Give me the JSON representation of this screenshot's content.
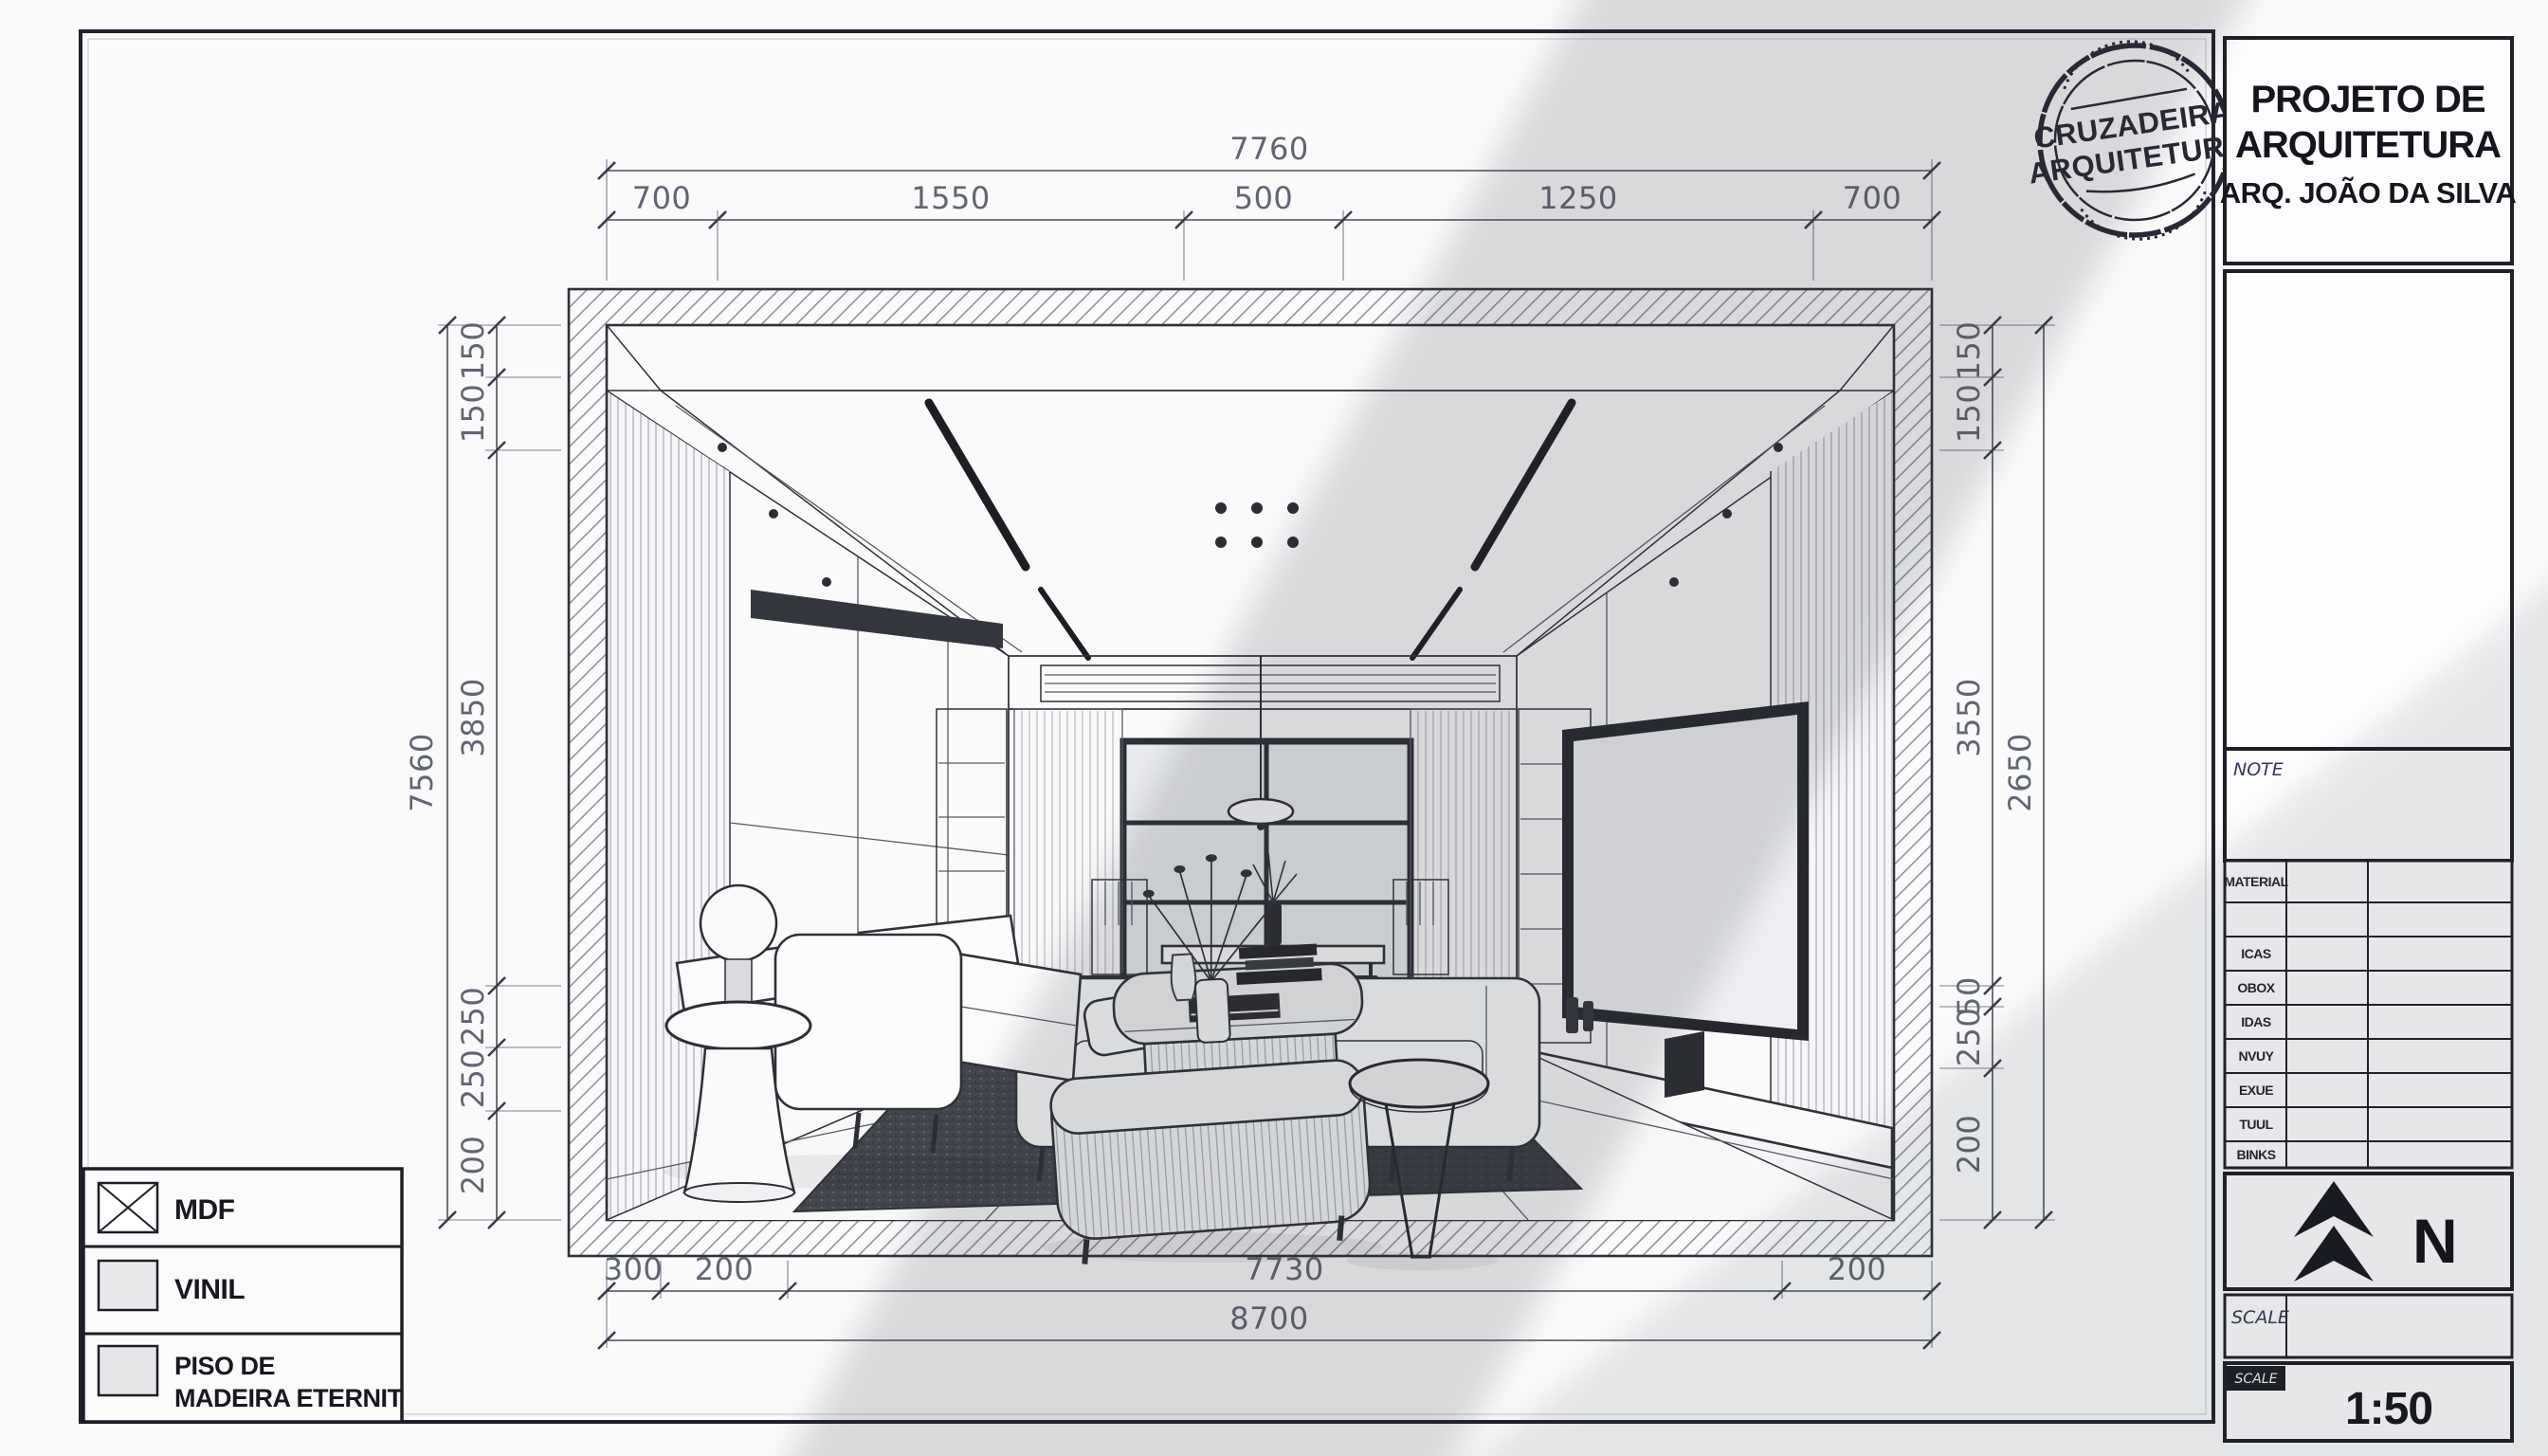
{
  "title_block": {
    "project_title_line1": "PROJETO DE",
    "project_title_line2": "ARQUITETURA",
    "architect": "ARQ. JOÃO DA SILVA",
    "note_label": "NOTE",
    "info_table": {
      "rows": [
        "MATERIAL",
        "",
        "ICAS",
        "OBOX",
        "IDAS",
        "NVUY",
        "EXUE",
        "TUUL",
        "BINKS"
      ]
    },
    "north_label": "N",
    "scale_row_label": "SCALE",
    "scale_label": "SCALE",
    "scale_value": "1:50"
  },
  "stamp": {
    "line1": "CRUZADEIRA",
    "line2": "ARQUITETURA"
  },
  "legend": {
    "items": [
      {
        "label": "MDF",
        "swatch": "x-hatch"
      },
      {
        "label": "VINIL",
        "swatch": "light-solid"
      },
      {
        "label": "PISO DE",
        "label2": "MADEIRA ETERNIT",
        "swatch": "gray-solid"
      }
    ]
  },
  "dims": {
    "top": {
      "overall": "7760",
      "chain": [
        "700",
        "1550",
        "500",
        "1250",
        "700"
      ]
    },
    "bottom": {
      "overall": "8700",
      "chain": [
        "300",
        "200",
        "7730",
        "200"
      ]
    },
    "left": {
      "overall": "7560",
      "chain": [
        "150",
        "150",
        "3850",
        "250",
        "250",
        "200"
      ]
    },
    "right": {
      "overall": "2650",
      "chain": [
        "150",
        "150",
        "3550",
        "50",
        "250",
        "200"
      ]
    }
  },
  "colors": {
    "paper": "#fafafb",
    "line": "#2e3138",
    "dim_text": "#5f6572",
    "dark": "#17191f",
    "stamp": "#262834",
    "note_blue": "#2f3a56",
    "rug": "#45484f",
    "shadow": "#30343c"
  }
}
